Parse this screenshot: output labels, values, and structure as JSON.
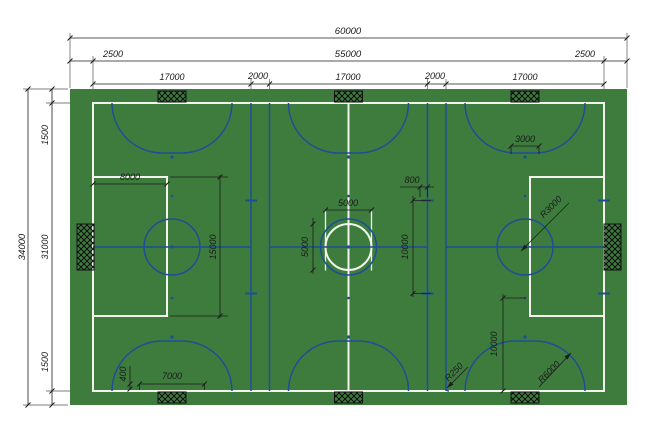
{
  "colors": {
    "field_green": "#3E7C3E",
    "line_white": "#F2F3EC",
    "line_blue": "#1D4E96",
    "dim": "#1C1C1C",
    "goal_black": "#111111",
    "background": "#FFFFFF"
  },
  "dims": {
    "top_total": "60000",
    "top_row2": [
      "2500",
      "55000",
      "2500"
    ],
    "top_row3": [
      "17000",
      "2000",
      "17000",
      "2000",
      "17000"
    ],
    "left_total": "34000",
    "left_segments": [
      "1500",
      "31000",
      "1500"
    ],
    "penalty_area_depth": "8000",
    "penalty_area_width": "15000",
    "goal_zone_width": "7000",
    "line_offset": "400",
    "center_circle_width": "5000",
    "center_circle_height": "5000",
    "ten_meter_span": "10000",
    "mark_length": "800",
    "goal_width": "3000",
    "center_circle_radius": "R3000",
    "penalty_arc_radius": "R6000",
    "corner_arc_radius": "R250",
    "ten_meter_bottom": "10000"
  }
}
